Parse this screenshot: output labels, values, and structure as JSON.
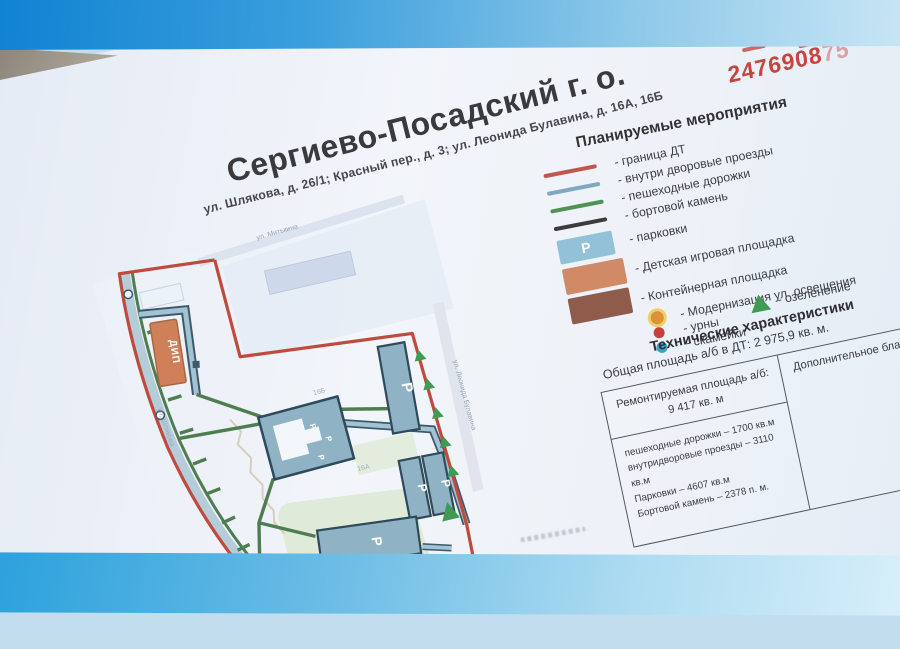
{
  "scene": {
    "background_top_blue": "#0f82d2",
    "background_bottom_blue": "#2ba1dc",
    "paper_color": "#f2f5fa"
  },
  "poster": {
    "title": "Сергиево-Посадский г. о.",
    "subtitle": "ул. Шлякова, д. 26/1; Красный пер., д. 3; ул. Леонида Булавина, д. 16А, 16Б",
    "stamp": {
      "number_main": "2476908",
      "number_faded": "75",
      "color": "#c5443e"
    },
    "legend": {
      "heading": "Планируемые мероприятия",
      "items": [
        {
          "label": "- граница ДТ",
          "swatch": "line",
          "color": "#c2554e"
        },
        {
          "label": "- внутри дворовые проезды",
          "swatch": "line",
          "color": "#7fa9c2"
        },
        {
          "label": "- пешеходные дорожки",
          "swatch": "line",
          "color": "#4f9254"
        },
        {
          "label": "- бортовой камень",
          "swatch": "line",
          "color": "#3c3c3e"
        },
        {
          "label": "- парковки",
          "swatch": "parking-rect",
          "color": "#93c2d8",
          "letter": "Р"
        },
        {
          "label": "- Детская игровая площадка",
          "swatch": "rect",
          "color": "#d08a65"
        },
        {
          "label": "- Контейнерная площадка",
          "swatch": "rect",
          "color": "#8f5c4c"
        },
        {
          "label": "- Модернизация ул. освещения",
          "swatch": "dot",
          "color": "#df903a"
        },
        {
          "label": "- урны",
          "swatch": "dot",
          "color": "#c8403c"
        },
        {
          "label": "- скамейки",
          "swatch": "dot",
          "color": "#36a3c9"
        },
        {
          "label": "- озеленение",
          "swatch": "triangle",
          "color": "#3f9b52"
        }
      ]
    },
    "tech": {
      "heading": "Технические характеристики",
      "total": "Общая площадь а/б в ДТ: 2 975,9 кв. м.",
      "table": {
        "repair_header_line1": "Ремонтируемая площадь а/б:",
        "repair_header_line2": "9 417 кв. м",
        "details": [
          "пешеходные дорожки – 1700 кв.м",
          "внутридворовые проезды – 3110 кв.м",
          "Парковки – 4607 кв.м",
          "Бортовой камень – 2378 п. м."
        ],
        "right_header": "Дополнительное благ"
      }
    },
    "map": {
      "street_top": "ул. Митькина",
      "street_right": "ул. Леонида Булавина",
      "street_left": "ул. Шлякова",
      "playground_label": "ДИП",
      "parking_letter": "Р",
      "building_label_a": "16А",
      "building_label_b": "16Б"
    }
  }
}
